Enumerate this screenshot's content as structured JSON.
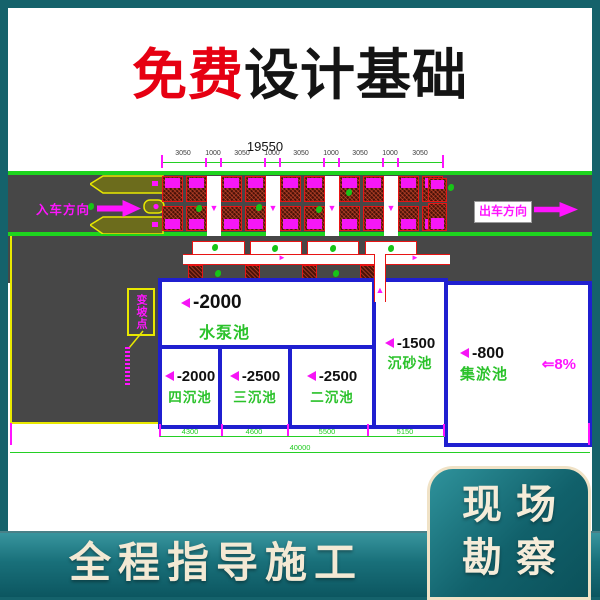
{
  "title": {
    "highlight": "免费",
    "rest": "设计基础"
  },
  "plan": {
    "top_dimension": {
      "total": "19550",
      "segments": [
        "3050",
        "1000",
        "3050",
        "1000",
        "3050",
        "1000",
        "3050",
        "1000",
        "3050"
      ]
    },
    "road": {
      "entry_label": "入车方向",
      "exit_label": "出车方向"
    },
    "annotation": {
      "slope_point_label": "变坡点"
    },
    "pools": [
      {
        "depth": "-2000",
        "name": "水泵池"
      },
      {
        "depth": "-2000",
        "name": "四沉池"
      },
      {
        "depth": "-2500",
        "name": "三沉池"
      },
      {
        "depth": "-2500",
        "name": "二沉池"
      },
      {
        "depth": "-1500",
        "name": "沉砂池"
      },
      {
        "depth": "-800",
        "name": "集淤池",
        "slope": "⇐8%"
      }
    ],
    "bottom_dimension": {
      "segments": [
        "4300",
        "4600",
        "5500",
        "5150"
      ],
      "total": "40000"
    }
  },
  "footer": {
    "banner_text": "全程指导施工",
    "corner_panel": {
      "line1": "现场",
      "line2": "勘察"
    }
  },
  "colors": {
    "page_teal": "#15626b",
    "accent_red": "#e60012",
    "cad_magenta": "#ff00ff",
    "cad_green": "#22cc22",
    "pool_border_blue": "#1f1fd0",
    "banner_cream": "#f3e9d4"
  }
}
